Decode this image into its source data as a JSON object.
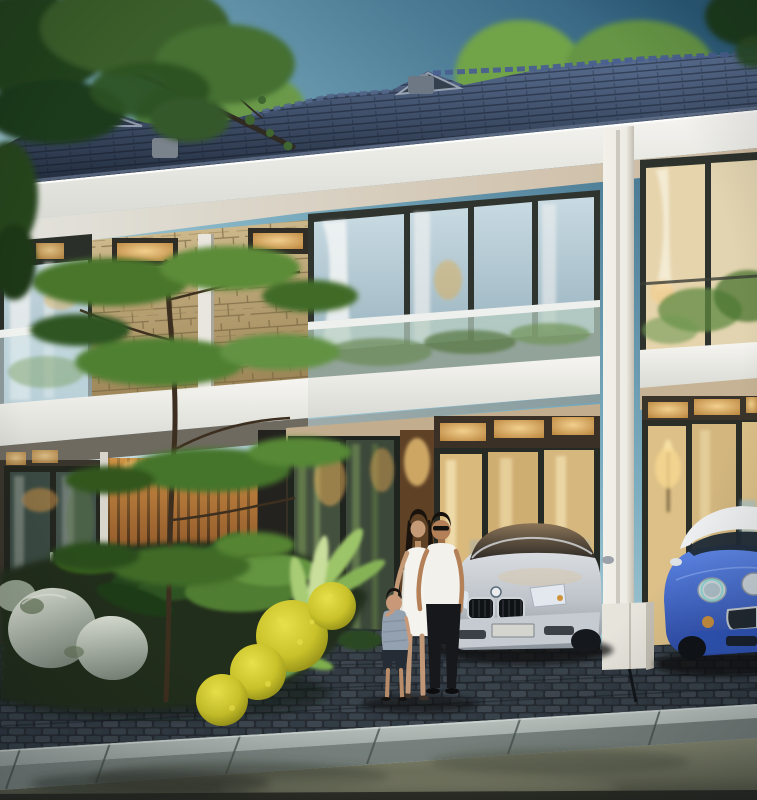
{
  "scene": {
    "description": "Dusk 3D architectural rendering of modern two-story townhouses with dark hip roofs, glass balconies, a stone feature wall and warm-lit interiors; a family of three poses on a paver driveway beside a silver sedan and a blue Mini Cooper, with tropical landscaping, boulders and a wet road in the foreground.",
    "elements": [
      "sky",
      "background-trees",
      "roof",
      "fascia",
      "soffit",
      "balcony-left",
      "stone-feature-wall",
      "clerestory-windows",
      "window-wall-center",
      "glass-balustrade",
      "balcony-band",
      "white-column",
      "right-unit-glass-wall",
      "ground-floor-doors",
      "wood-slat-wall",
      "transom-windows",
      "garden-bed",
      "rocks",
      "tropical-plants",
      "yellow-flower-shrubs",
      "garden-tree",
      "overhanging-tree",
      "paver-driveway",
      "curb",
      "wet-road",
      "bmw-sedan",
      "mini-cooper",
      "family-father",
      "family-mother",
      "family-boy"
    ],
    "palette": {
      "sky_top": "#2b5a78",
      "sky_mid": "#7fb0c2",
      "sky_low": "#d9e9ea",
      "roof_light": "#5a6f92",
      "roof_dark": "#212b3b",
      "ridge": "#4a6090",
      "fascia": "#f6f5f1",
      "fascia_shade": "#d9dad4",
      "soffit_warm": "#cbb89e",
      "soffit_cool": "#e3e3dd",
      "frame_dark": "#2b2f2a",
      "glass_cool_hi": "#c8dae2",
      "glass_cool_lo": "#9ab4c0",
      "curtain_warm": "#e6d4ac",
      "warm_light": "#f2cf8e",
      "warm_deep": "#b9843c",
      "stone_hi": "#d3bf92",
      "stone_lo": "#9c8456",
      "stone_line": "#73603c",
      "wood_hi": "#c08244",
      "wood_lo": "#5a3418",
      "column": "#eeebe4",
      "foliage_hi": "#6f9c45",
      "foliage_mid": "#49762c",
      "foliage_lo": "#24431d",
      "flower_yellow": "#c9c22a",
      "flower_hi": "#e8e04a",
      "rock_hi": "#dde2d6",
      "rock_lo": "#7b877b",
      "paver_base": "#262c32",
      "paver_hi": "#46505a",
      "curb_hi": "#b6beba",
      "curb_lo": "#79837f",
      "road_hi": "#8b8e75",
      "road_lo": "#4b4e40",
      "road_dark": "#23251e",
      "bmw_silver_hi": "#e0e4e8",
      "bmw_silver_lo": "#8b929a",
      "mini_blue_hi": "#5d86e4",
      "mini_blue_lo": "#2b4aa6",
      "mini_roof": "#eceef0",
      "skin": "#c59a76",
      "hair": "#1a130d",
      "dress_white": "#f4f3ee",
      "pants_black": "#17181c",
      "boy_shirt": "#94a1b0",
      "boy_shorts": "#262c36",
      "shadow": "#0b0e11"
    }
  }
}
